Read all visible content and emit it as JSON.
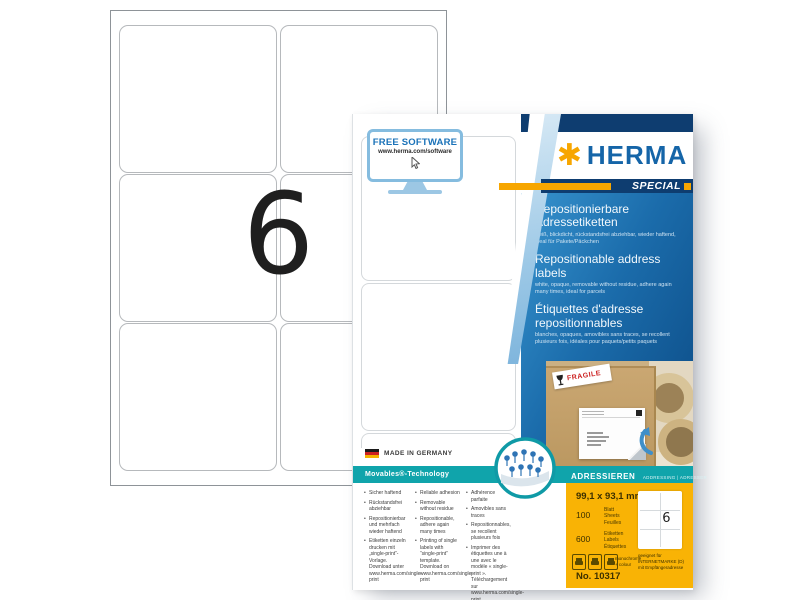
{
  "colors": {
    "brand-blue": "#1565a8",
    "brand-orange": "#f7a600",
    "navy": "#0e3d70",
    "teal": "#10a4ab",
    "pack-orange": "#f9b305",
    "fragile-red": "#cc2222"
  },
  "sheet": {
    "big_count": "6"
  },
  "package": {
    "free_software": {
      "title": "FREE SOFTWARE",
      "url": "www.herma.com/software"
    },
    "brand": {
      "name": "HERMA",
      "asterisk": "✱",
      "special": "SPECIAL"
    },
    "titles": {
      "de": {
        "title": "Repositionierbare Adressetiketten",
        "sub": "weiß, blickdicht, rückstandsfrei abziehbar, wieder haftend, ideal für Pakete/Päckchen"
      },
      "en": {
        "title": "Repositionable address labels",
        "sub": "white, opaque, removable without residue, adhere again many times, ideal for parcels"
      },
      "fr": {
        "title": "Étiquettes d'adresse repositionnables",
        "sub": "blanches, opaques, amovibles sans traces, se recollent plusieurs fois, idéales pour paquets/petits paquets"
      }
    },
    "photo": {
      "fragile": "FRAGILE"
    },
    "made_in": "MADE IN GERMANY",
    "tech_bar": {
      "left": "Movables®-Technology",
      "right_main": "ADRESSIEREN",
      "right_sub": "ADDRESSING | ADRESSER"
    },
    "bullets": {
      "de": [
        "Sicher haftend",
        "Rückstandsfrei abziehbar",
        "Repositionierbar und mehrfach wieder haftend",
        "Etiketten einzeln drucken mit „single-print“-Vorlage. Download unter www.herma.com/single-print"
      ],
      "en": [
        "Reliable adhesion",
        "Removable without residue",
        "Repositionable, adhere again many times",
        "Printing of single labels with “single-print” template. Download on www.herma.com/single-print"
      ],
      "fr": [
        "Adhérence parfaite",
        "Amovibles sans traces",
        "Repositionnables, se recollent plusieurs fois",
        "Imprimer des étiquettes une à une avec le modèle « single-print ». Téléchargement sur www.herma.com/single-print"
      ]
    },
    "specs": {
      "size": "99,1 x 93,1 mm",
      "sheets_count": "100",
      "sheets_units": [
        "Blatt",
        "Sheets",
        "Feuilles"
      ],
      "labels_count": "600",
      "labels_units": [
        "Etiketten",
        "Labels",
        "Étiquettes"
      ],
      "print_note_1": "monochrome",
      "print_note_2": "+ colour",
      "mini_count": "6",
      "suitability": "geeignet für INTERNETMARKE (D) mit Empfängeradresse",
      "item_no": "No. 10317"
    }
  }
}
